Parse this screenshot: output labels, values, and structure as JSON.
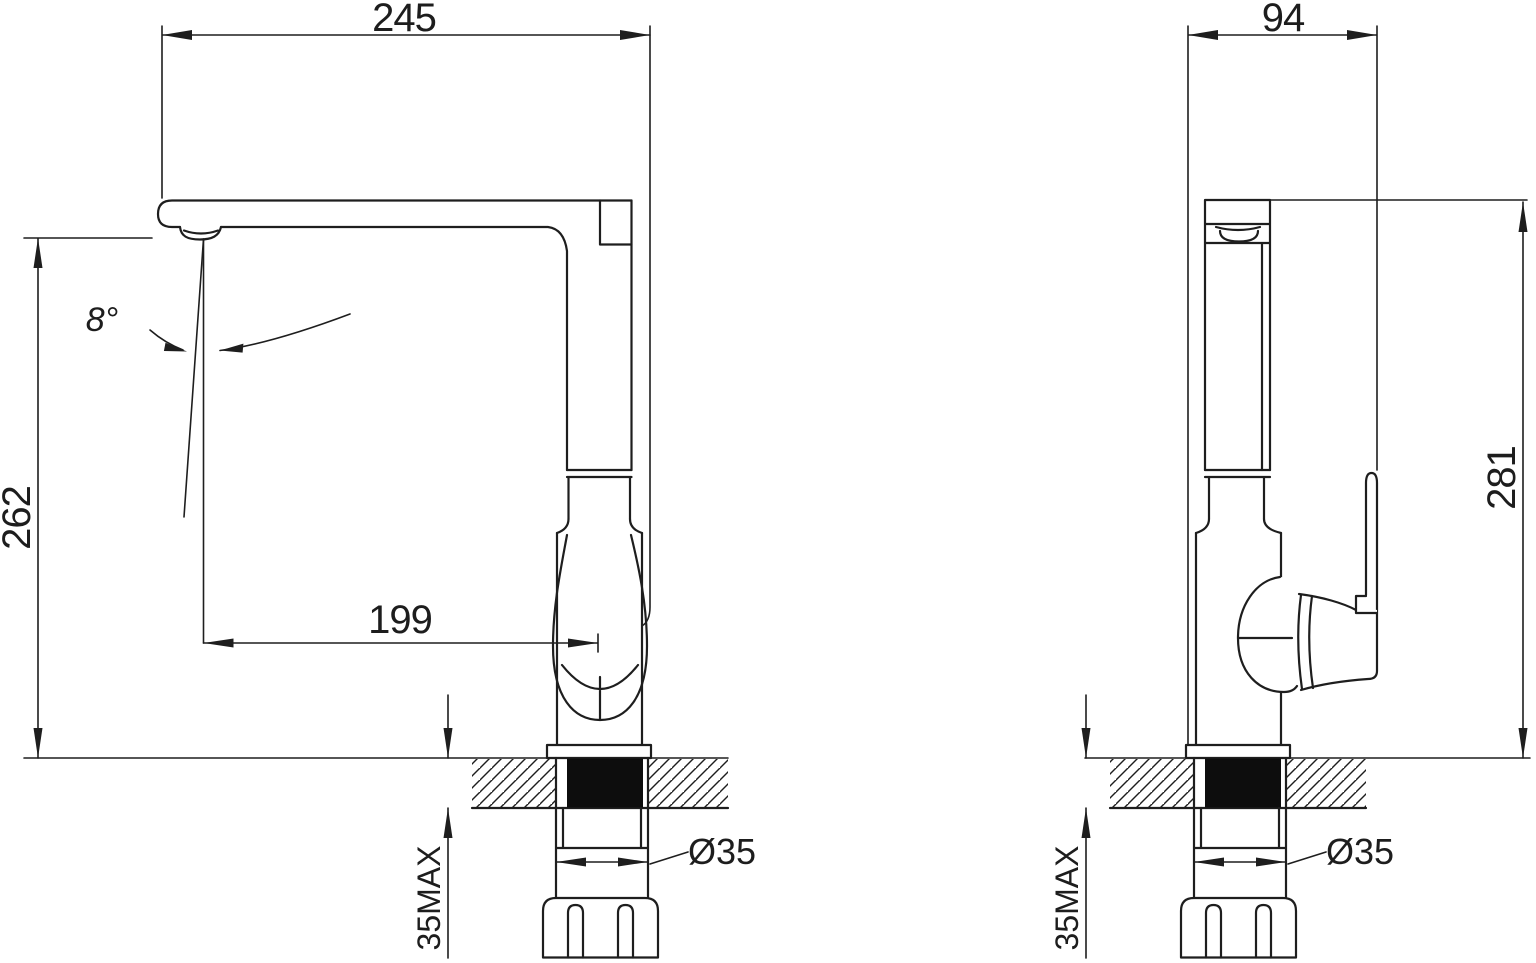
{
  "front_view": {
    "width": "245",
    "height": "262",
    "spout_reach": "199",
    "spout_angle": "8°",
    "hole_diameter": "Ø35",
    "max_deck_thickness": "35MAX"
  },
  "side_view": {
    "depth": "94",
    "height": "281",
    "hole_diameter": "Ø35",
    "max_deck_thickness": "35MAX"
  }
}
